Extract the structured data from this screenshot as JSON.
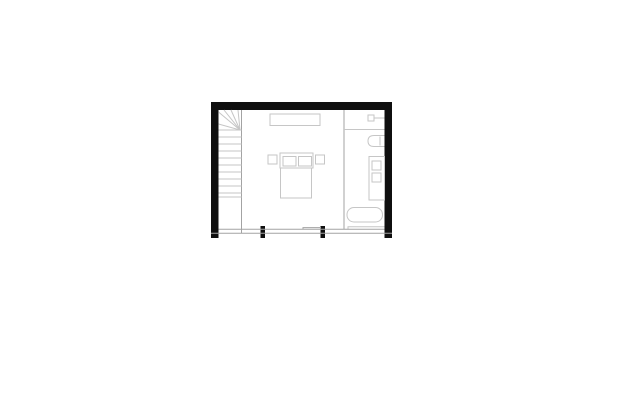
{
  "palette": {
    "wall": "#0f0f0f",
    "line_light": "#c6c6c6",
    "line_mid": "#a3a3a3",
    "background": "#ffffff"
  },
  "floor_plan": {
    "name": "loft-bedroom-bathroom-floor-plan",
    "canvas": {
      "width": 618,
      "height": 412
    },
    "elements": [
      {
        "name": "top-wall",
        "type": "rect",
        "x": 211,
        "y": 102,
        "w": 181,
        "h": 8,
        "fill": "wall"
      },
      {
        "name": "left-wall",
        "type": "rect",
        "x": 211,
        "y": 102,
        "w": 7.5,
        "h": 136,
        "fill": "wall"
      },
      {
        "name": "right-wall",
        "type": "rect",
        "x": 384.5,
        "y": 102,
        "w": 7.5,
        "h": 136,
        "fill": "wall"
      },
      {
        "name": "window-mullion-left",
        "type": "rect",
        "x": 260.5,
        "y": 226,
        "w": 4.5,
        "h": 12,
        "fill": "wall"
      },
      {
        "name": "window-mullion-right",
        "type": "rect",
        "x": 320.5,
        "y": 226,
        "w": 4.5,
        "h": 12,
        "fill": "wall"
      },
      {
        "name": "stair-side-line",
        "type": "line",
        "x1": 241.5,
        "y1": 110,
        "x2": 241.5,
        "y2": 233,
        "stroke": "line_mid"
      },
      {
        "name": "stair-winder-ray-1",
        "type": "line",
        "x1": 240,
        "y1": 130,
        "x2": 218.5,
        "y2": 124,
        "stroke": "line_light"
      },
      {
        "name": "stair-winder-ray-2",
        "type": "line",
        "x1": 240,
        "y1": 130,
        "x2": 218.5,
        "y2": 112,
        "stroke": "line_light"
      },
      {
        "name": "stair-winder-ray-3",
        "type": "line",
        "x1": 240,
        "y1": 130,
        "x2": 224,
        "y2": 110,
        "stroke": "line_light"
      },
      {
        "name": "stair-winder-ray-4",
        "type": "line",
        "x1": 240,
        "y1": 130,
        "x2": 231,
        "y2": 110,
        "stroke": "line_light"
      },
      {
        "name": "stair-winder-ray-5",
        "type": "line",
        "x1": 240,
        "y1": 130,
        "x2": 238,
        "y2": 110,
        "stroke": "line_light"
      },
      {
        "name": "stair-tread-1",
        "type": "line",
        "x1": 218.5,
        "y1": 130,
        "x2": 241.5,
        "y2": 130,
        "stroke": "line_light"
      },
      {
        "name": "stair-tread-2",
        "type": "line",
        "x1": 218.5,
        "y1": 137,
        "x2": 241.5,
        "y2": 137,
        "stroke": "line_light"
      },
      {
        "name": "stair-tread-3",
        "type": "line",
        "x1": 218.5,
        "y1": 144,
        "x2": 241.5,
        "y2": 144,
        "stroke": "line_light"
      },
      {
        "name": "stair-tread-4",
        "type": "line",
        "x1": 218.5,
        "y1": 151,
        "x2": 241.5,
        "y2": 151,
        "stroke": "line_light"
      },
      {
        "name": "stair-tread-5",
        "type": "line",
        "x1": 218.5,
        "y1": 158,
        "x2": 241.5,
        "y2": 158,
        "stroke": "line_light"
      },
      {
        "name": "stair-tread-6",
        "type": "line",
        "x1": 218.5,
        "y1": 165,
        "x2": 241.5,
        "y2": 165,
        "stroke": "line_light"
      },
      {
        "name": "stair-tread-7",
        "type": "line",
        "x1": 218.5,
        "y1": 172,
        "x2": 241.5,
        "y2": 172,
        "stroke": "line_light"
      },
      {
        "name": "stair-tread-8",
        "type": "line",
        "x1": 218.5,
        "y1": 179,
        "x2": 241.5,
        "y2": 179,
        "stroke": "line_light"
      },
      {
        "name": "stair-tread-9",
        "type": "line",
        "x1": 218.5,
        "y1": 186,
        "x2": 241.5,
        "y2": 186,
        "stroke": "line_light"
      },
      {
        "name": "stair-tread-10",
        "type": "line",
        "x1": 218.5,
        "y1": 193,
        "x2": 241.5,
        "y2": 193,
        "stroke": "line_light"
      },
      {
        "name": "stair-landing-line",
        "type": "line",
        "x1": 218.5,
        "y1": 197,
        "x2": 241.5,
        "y2": 197,
        "stroke": "line_light"
      },
      {
        "name": "wardrobe",
        "type": "rect",
        "x": 270,
        "y": 114,
        "w": 50,
        "h": 11.5,
        "stroke": "line_light",
        "fill": "none"
      },
      {
        "name": "nightstand-left",
        "type": "rect",
        "x": 268,
        "y": 155,
        "w": 9,
        "h": 9,
        "stroke": "line_light",
        "fill": "none"
      },
      {
        "name": "bed-headboard",
        "type": "rect",
        "x": 280,
        "y": 153,
        "w": 33,
        "h": 15,
        "stroke": "line_light",
        "fill": "none"
      },
      {
        "name": "pillow-left",
        "type": "rect",
        "x": 283,
        "y": 156.5,
        "w": 13,
        "h": 9.5,
        "stroke": "line_light",
        "fill": "none"
      },
      {
        "name": "pillow-right",
        "type": "rect",
        "x": 298.5,
        "y": 156.5,
        "w": 13,
        "h": 9.5,
        "stroke": "line_light",
        "fill": "none"
      },
      {
        "name": "nightstand-right",
        "type": "rect",
        "x": 315.5,
        "y": 155,
        "w": 9,
        "h": 9,
        "stroke": "line_light",
        "fill": "none"
      },
      {
        "name": "bed",
        "type": "rect",
        "x": 280.5,
        "y": 168,
        "w": 31,
        "h": 30,
        "stroke": "line_light",
        "fill": "none"
      },
      {
        "name": "bathroom-partition-line",
        "type": "line",
        "x1": 344,
        "y1": 110,
        "x2": 344,
        "y2": 229.3,
        "stroke": "line_mid"
      },
      {
        "name": "bathroom-shelf-line",
        "type": "line",
        "x1": 344,
        "y1": 129.5,
        "x2": 384.5,
        "y2": 129.5,
        "stroke": "line_light"
      },
      {
        "name": "shower-valve",
        "type": "rect",
        "x": 368,
        "y": 115,
        "w": 6,
        "h": 6,
        "stroke": "line_light",
        "fill": "none"
      },
      {
        "name": "shower-arm-line",
        "type": "line",
        "x1": 374,
        "y1": 118,
        "x2": 384.5,
        "y2": 118,
        "stroke": "line_light"
      },
      {
        "name": "toilet",
        "type": "path",
        "d": "M384.5,135.5 H374 Q368,135.5 368,141 Q368,146.5 374,146.5 H384.5",
        "stroke": "line_light",
        "fill": "none"
      },
      {
        "name": "toilet-tank-line",
        "type": "line",
        "x1": 380,
        "y1": 136.5,
        "x2": 380,
        "y2": 145.5,
        "stroke": "line_light"
      },
      {
        "name": "vanity-cabinet",
        "type": "rect",
        "x": 369,
        "y": 156.5,
        "w": 15.5,
        "h": 43.5,
        "stroke": "line_light",
        "fill": "none"
      },
      {
        "name": "vanity-basin-1",
        "type": "rect",
        "x": 372,
        "y": 161,
        "w": 9,
        "h": 9,
        "stroke": "line_light",
        "fill": "none"
      },
      {
        "name": "vanity-basin-2",
        "type": "rect",
        "x": 372,
        "y": 173,
        "w": 9,
        "h": 9,
        "stroke": "line_light",
        "fill": "none"
      },
      {
        "name": "bathtub",
        "type": "rect",
        "x": 347,
        "y": 207.5,
        "w": 35.5,
        "h": 14.5,
        "rx": 7,
        "stroke": "line_light",
        "fill": "none"
      },
      {
        "name": "bath-floor-step",
        "type": "polyline",
        "points": "348,229.3 348,226.7 384.5,226.7",
        "stroke": "line_light"
      },
      {
        "name": "window-sill-inner-line",
        "type": "line",
        "x1": 218.5,
        "y1": 229.3,
        "x2": 384.5,
        "y2": 229.3,
        "stroke": "line_mid"
      },
      {
        "name": "window-sill-step",
        "type": "polyline",
        "points": "303,229.3 303,227.6 321,227.6",
        "stroke": "line_mid"
      },
      {
        "name": "window-sill-outer-line",
        "type": "line",
        "x1": 211,
        "y1": 233.2,
        "x2": 392,
        "y2": 233.2,
        "stroke": "line_mid"
      }
    ]
  }
}
